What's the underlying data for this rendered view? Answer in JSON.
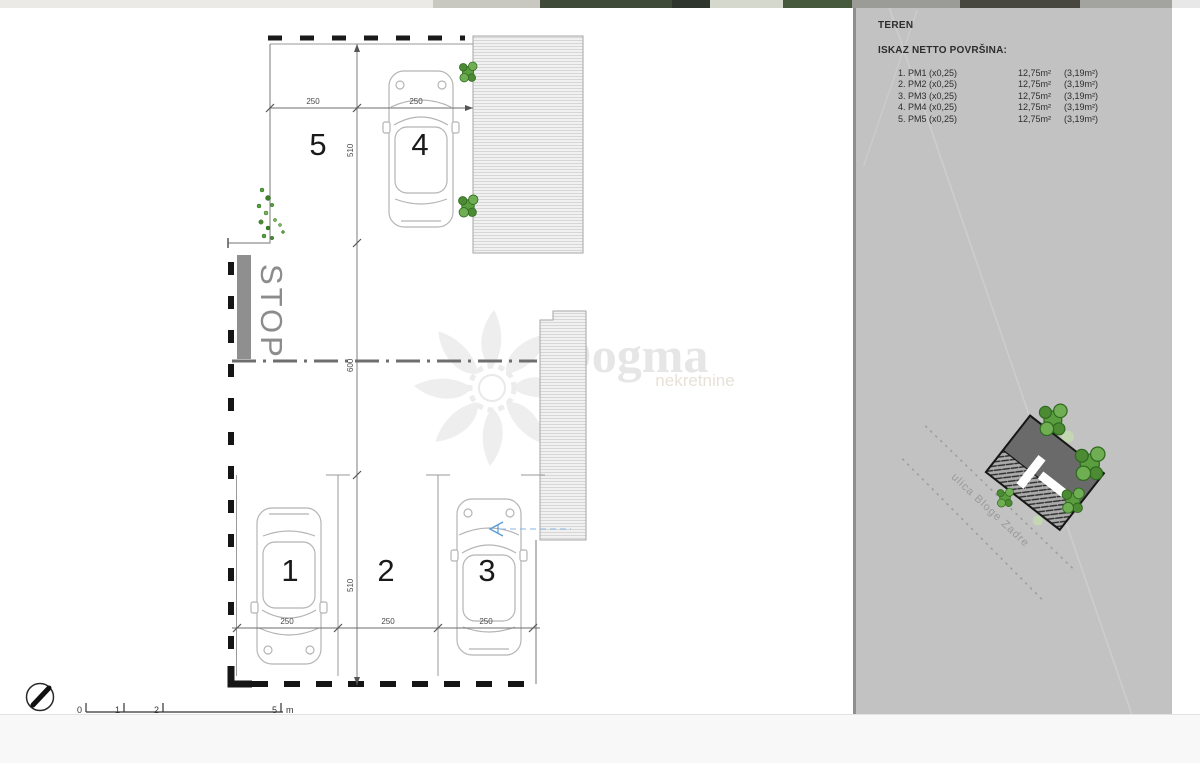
{
  "panel": {
    "title": "TEREN",
    "subtitle": "ISKAZ NETTO POVRŠINA:",
    "rows": [
      {
        "label": "1. PM1 (x0,25)",
        "value": "12,75m²",
        "coef": "(3,19m²)"
      },
      {
        "label": "2. PM2 (x0,25)",
        "value": "12,75m²",
        "coef": "(3,19m²)"
      },
      {
        "label": "3. PM3 (x0,25)",
        "value": "12,75m²",
        "coef": "(3,19m²)"
      },
      {
        "label": "4. PM4 (x0,25)",
        "value": "12,75m²",
        "coef": "(3,19m²)"
      },
      {
        "label": "5. PM5 (x0,25)",
        "value": "12,75m²",
        "coef": "(3,19m²)"
      }
    ],
    "map": {
      "street": "ulica Bloge Zadre"
    }
  },
  "plan": {
    "stop_label": "STOP",
    "spots": {
      "s1": "1",
      "s2": "2",
      "s3": "3",
      "s4": "4",
      "s5": "5"
    },
    "dims": {
      "top_w1": "250",
      "top_w2": "250",
      "height_top": "510",
      "aisle": "600",
      "height_bottom": "510",
      "bot_w1": "250",
      "bot_w2": "250",
      "bot_w3": "250"
    },
    "scale": {
      "m0": "0",
      "m1": "1",
      "m2": "2",
      "m5": "5",
      "unit": "m"
    }
  },
  "watermark": {
    "title": "Dogma",
    "subtitle": "nekretnine"
  },
  "colors": {
    "panel_bg": "#c2c2c2",
    "boundary_dark": "#1a1a1a",
    "thin_line": "#8f8f8f",
    "car_line": "#b5b5b5",
    "stop_gray": "#8f8f8f",
    "dim_text": "#4a4a4a",
    "green_dark": "#2f6b1f",
    "green": "#5a9e3f",
    "annotation_blue": "#5b9bd5",
    "watermark_gray": "#e7e7e7"
  }
}
